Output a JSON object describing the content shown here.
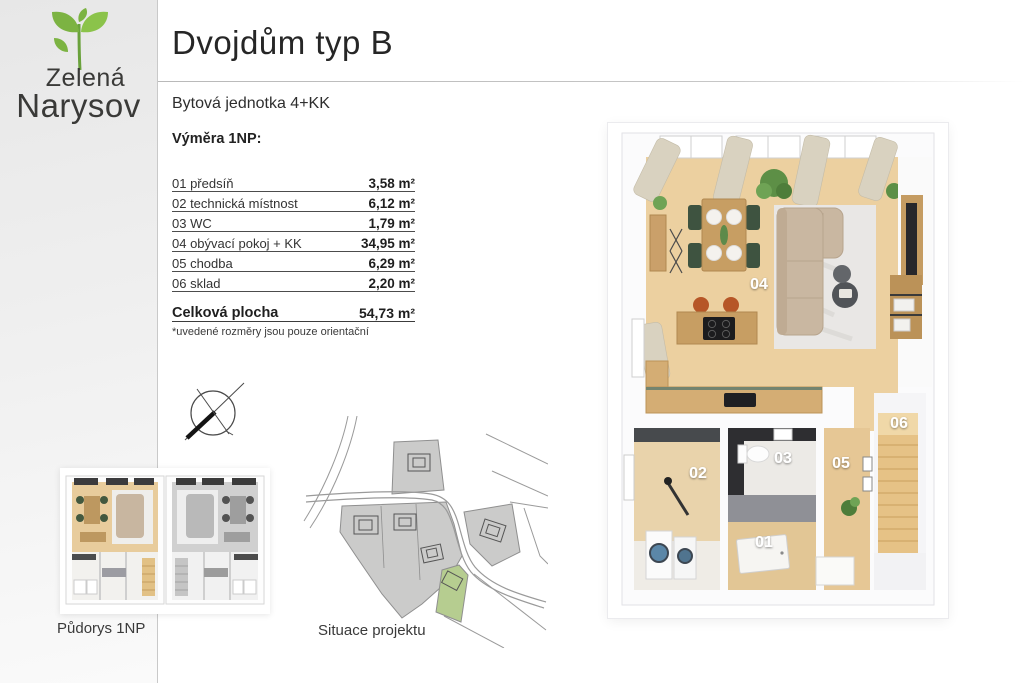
{
  "brand": {
    "line1": "Zelená",
    "line2": "Narysov"
  },
  "header": {
    "title": "Dvojdům typ B",
    "subtitle": "Bytová jednotka 4+KK"
  },
  "area_table": {
    "heading": "Výměra 1NP:",
    "rows": [
      {
        "label": "01 předsíň",
        "value": "3,58 m²"
      },
      {
        "label": "02 technická místnost",
        "value": "6,12 m²"
      },
      {
        "label": "03 WC",
        "value": "1,79 m²"
      },
      {
        "label": "04 obývací pokoj + KK",
        "value": "34,95 m²"
      },
      {
        "label": "05 chodba",
        "value": "6,29 m²"
      },
      {
        "label": "06 sklad",
        "value": "2,20 m²"
      }
    ],
    "total_label": "Celková plocha",
    "total_value": "54,73 m²",
    "footnote": "*uvedené rozměry jsou pouze orientační"
  },
  "captions": {
    "floorplan_thumb": "Půdorys 1NP",
    "site_plan": "Situace projektu"
  },
  "floorplan": {
    "rooms": [
      {
        "number": "01"
      },
      {
        "number": "02"
      },
      {
        "number": "03"
      },
      {
        "number": "04"
      },
      {
        "number": "05"
      },
      {
        "number": "06"
      }
    ]
  },
  "colors": {
    "brand_green": "#7cb342",
    "wood_floor": "#ecd0a0",
    "site_highlight": "#b6cd90",
    "dark_tile": "#2e2e31"
  }
}
